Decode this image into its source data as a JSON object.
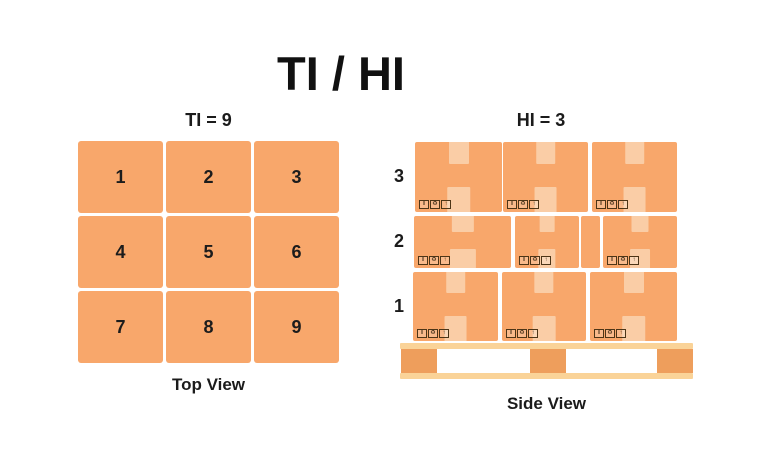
{
  "title": "TI / HI",
  "colors": {
    "box": "#F8A76B",
    "tape": "#FACDA6",
    "pallet_board": "#FAD398",
    "pallet_block": "#EE9E5C",
    "text": "#1B1B1B"
  },
  "top_view": {
    "header": "TI = 9",
    "caption": "Top View",
    "cells": [
      "1",
      "2",
      "3",
      "4",
      "5",
      "6",
      "7",
      "8",
      "9"
    ]
  },
  "side_view": {
    "header": "HI = 3",
    "caption": "Side View",
    "box_label_icons": [
      {
        "name": "fragile-icon",
        "glyph": "‖"
      },
      {
        "name": "recycle-icon",
        "glyph": "♻"
      },
      {
        "name": "this-way-up-icon",
        "glyph": "↑"
      }
    ],
    "layers": [
      {
        "label": "3",
        "top": 142,
        "height": 70,
        "boxes": [
          {
            "left": 415,
            "width": 87,
            "tape": true,
            "icons": true
          },
          {
            "left": 503,
            "width": 85,
            "tape": true,
            "icons": true
          },
          {
            "left": 592,
            "width": 85,
            "tape": true,
            "icons": true
          }
        ]
      },
      {
        "label": "2",
        "top": 216,
        "height": 52,
        "boxes": [
          {
            "left": 414,
            "width": 97,
            "tape": true,
            "icons": true
          },
          {
            "left": 515,
            "width": 64,
            "tape": true,
            "icons": true
          },
          {
            "left": 581,
            "width": 19,
            "tape": false,
            "icons": false
          },
          {
            "left": 603,
            "width": 74,
            "tape": true,
            "icons": true
          }
        ]
      },
      {
        "label": "1",
        "top": 272,
        "height": 69,
        "boxes": [
          {
            "left": 413,
            "width": 85,
            "tape": true,
            "icons": true
          },
          {
            "left": 502,
            "width": 84,
            "tape": true,
            "icons": true
          },
          {
            "left": 590,
            "width": 87,
            "tape": true,
            "icons": true
          }
        ]
      }
    ],
    "pallet": {
      "left": 400,
      "width": 293,
      "top_board_y": 343,
      "board_height": 6,
      "block_y": 349,
      "block_height": 24,
      "block_width": 36,
      "block_xs": [
        401,
        530,
        657
      ],
      "bottom_board_y": 373
    }
  }
}
